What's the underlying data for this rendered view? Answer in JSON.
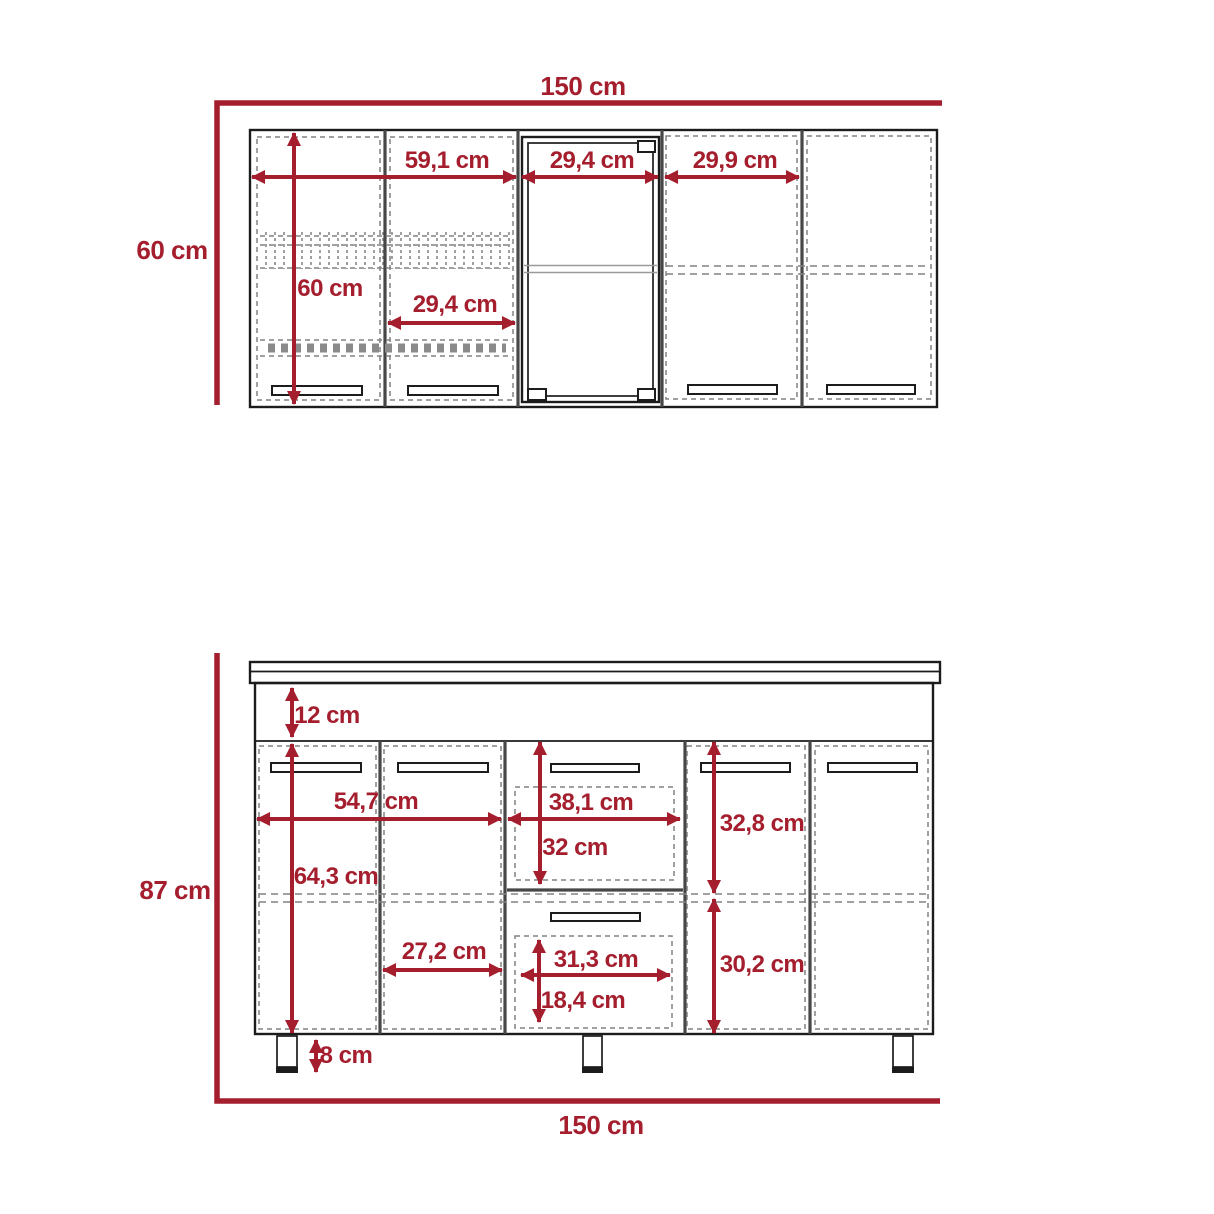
{
  "colors": {
    "dimension_red": "#a41e2e",
    "line_dark": "#1c1c1c",
    "divider_gray": "#474747",
    "dash_gray": "#828282"
  },
  "wall_cabinet": {
    "name": "wall cabinet front elevation",
    "labels": {
      "total_width": "150 cm",
      "side_height": "60 cm",
      "interior_height": "60 cm",
      "left_doors_width": "59,1 cm",
      "glass_door_width": "29,4 cm",
      "right_door_width": "29,9 cm",
      "single_door_width": "29,4 cm"
    }
  },
  "base_cabinet": {
    "name": "base cabinet front elevation",
    "labels": {
      "side_height": "87 cm",
      "total_width": "150 cm",
      "apron_height": "12 cm",
      "left_doors_width": "54,7 cm",
      "drawer_section_width": "38,1 cm",
      "upper_drawer_height": "32 cm",
      "upper_right_height": "32,8 cm",
      "door_height": "64,3 cm",
      "single_door_width": "27,2 cm",
      "lower_drawer_width": "31,3 cm",
      "lower_drawer_height": "18,4 cm",
      "lower_right_height": "30,2 cm",
      "leg_height": "8 cm"
    }
  }
}
